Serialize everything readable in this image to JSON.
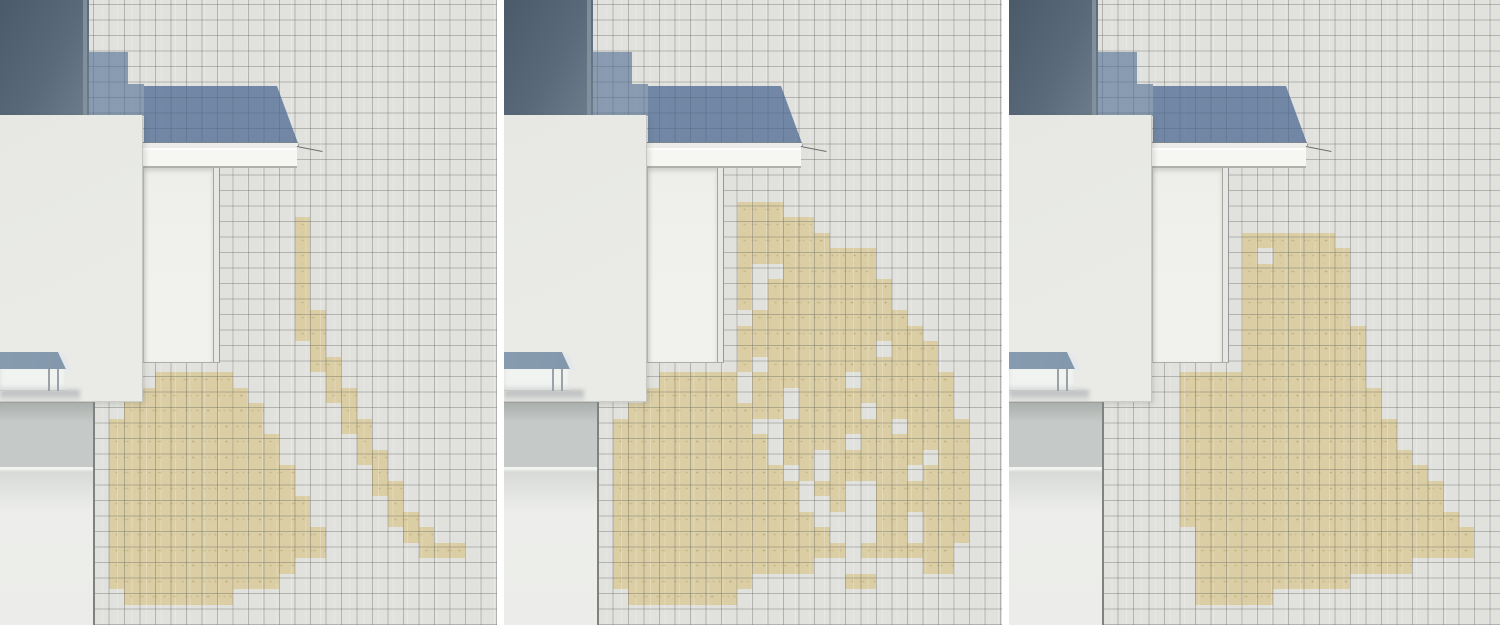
{
  "figure": {
    "panel_count": 3,
    "panel_ids": [
      "left",
      "middle",
      "right"
    ]
  },
  "colors": {
    "gutter": "#ffffff",
    "tile": "#e1e2de",
    "grid_line": "rgba(94,94,88,0.36)",
    "tan": "#dbcea4",
    "shadow_blue": "rgba(83,111,149,0.62)",
    "roof_blue": "rgba(70,100,143,0.72)",
    "chimney_dark": "#4b5a69",
    "chimney_mid": "#5a6979",
    "chimney_light": "#6d7d8c",
    "chimney_edge": "#8794a1",
    "eave": "#ecedea",
    "fascia": "#f6f6f3",
    "door": "#f1f1ee",
    "jamb": "#e7e7e3",
    "line_dark": "#a6a6a1",
    "panel_face": "#eaebe7",
    "panel_edge": "#c6c6c1",
    "awning_slope_dark": "#70849a",
    "awning_slope_light": "#8ca0b4",
    "awning_cap": "#e4e8eb",
    "awning_face": "#f1f3f1",
    "awning_post": "#9aa1a7",
    "band_top": "#aab0ad",
    "band": "#c5c9c7",
    "wall_shade": "#d8dad7",
    "wall_light": "#edeeeb",
    "corner": "#7f827f"
  },
  "layout": {
    "width": 1500,
    "height": 625,
    "tile_size": 15.5
  },
  "arch": {
    "chimney": {
      "x": 0,
      "y": 0,
      "w": 89,
      "h": 116
    },
    "chimney_edge": {
      "x": 83,
      "y": 0,
      "w": 4,
      "h": 116
    },
    "shadow_steps": [
      {
        "x": 88,
        "y": 52,
        "w": 40,
        "h": 64
      },
      {
        "x": 128,
        "y": 84,
        "w": 16,
        "h": 32
      }
    ],
    "roof": {
      "points": [
        [
          144,
          86
        ],
        [
          277,
          86
        ],
        [
          299,
          146
        ],
        [
          144,
          146
        ]
      ]
    },
    "eave_strip": {
      "x": 140,
      "y": 142,
      "w": 158,
      "h": 6
    },
    "fascia": {
      "x": 140,
      "y": 148,
      "w": 157,
      "h": 20
    },
    "leader": {
      "x": 297,
      "y": 146,
      "len": 26,
      "angle": 11
    },
    "door": {
      "x": 143,
      "y": 168,
      "w": 70,
      "h": 195
    },
    "jamb": {
      "x": 213,
      "y": 168,
      "w": 7,
      "h": 195
    },
    "front_panel": {
      "x": 0,
      "y": 115,
      "w": 143,
      "h": 287
    },
    "awning": {
      "slope": [
        [
          0,
          352
        ],
        [
          58,
          352
        ],
        [
          66,
          369
        ],
        [
          0,
          371
        ]
      ],
      "cap": [
        [
          58,
          352
        ],
        [
          66,
          355
        ],
        [
          72,
          371
        ],
        [
          66,
          369
        ]
      ],
      "face": {
        "x": 0,
        "y": 369,
        "w": 66,
        "h": 22
      },
      "posts": [
        {
          "x": 48,
          "y": 369,
          "w": 2,
          "h": 22
        },
        {
          "x": 57,
          "y": 369,
          "w": 2,
          "h": 22
        }
      ],
      "shadow": {
        "x": 0,
        "y": 390,
        "w": 80,
        "h": 13
      }
    },
    "base": {
      "band": {
        "x": 0,
        "y": 402,
        "w": 94,
        "h": 65
      },
      "wall": {
        "x": 0,
        "y": 467,
        "w": 94,
        "h": 158
      },
      "corner": {
        "x": 93,
        "y": 402,
        "w": 2,
        "h": 223
      }
    }
  },
  "panels": [
    {
      "id": "left",
      "x": 0,
      "w": 497,
      "rows": [
        {
          "r": 14,
          "segs": [
            [
              19,
              20
            ]
          ]
        },
        {
          "r": 15,
          "segs": [
            [
              19,
              20
            ]
          ]
        },
        {
          "r": 16,
          "segs": [
            [
              19,
              20
            ]
          ]
        },
        {
          "r": 17,
          "segs": [
            [
              19,
              20
            ]
          ]
        },
        {
          "r": 18,
          "segs": [
            [
              19,
              20
            ]
          ]
        },
        {
          "r": 19,
          "segs": [
            [
              19,
              20
            ]
          ]
        },
        {
          "r": 20,
          "segs": [
            [
              19,
              21
            ]
          ]
        },
        {
          "r": 21,
          "segs": [
            [
              19,
              21
            ]
          ]
        },
        {
          "r": 22,
          "segs": [
            [
              20,
              21
            ]
          ]
        },
        {
          "r": 23,
          "segs": [
            [
              20,
              22
            ]
          ]
        },
        {
          "r": 24,
          "segs": [
            [
              10,
              15
            ],
            [
              21,
              22
            ]
          ]
        },
        {
          "r": 25,
          "segs": [
            [
              8,
              16
            ],
            [
              21,
              23
            ]
          ]
        },
        {
          "r": 26,
          "segs": [
            [
              8,
              17
            ],
            [
              22,
              23
            ]
          ]
        },
        {
          "r": 27,
          "segs": [
            [
              7,
              17
            ],
            [
              22,
              24
            ]
          ]
        },
        {
          "r": 28,
          "segs": [
            [
              7,
              18
            ],
            [
              23,
              24
            ]
          ]
        },
        {
          "r": 29,
          "segs": [
            [
              7,
              18
            ],
            [
              23,
              25
            ]
          ]
        },
        {
          "r": 30,
          "segs": [
            [
              7,
              19
            ],
            [
              24,
              25
            ]
          ]
        },
        {
          "r": 31,
          "segs": [
            [
              7,
              19
            ],
            [
              24,
              26
            ]
          ]
        },
        {
          "r": 32,
          "segs": [
            [
              7,
              20
            ],
            [
              25,
              26
            ]
          ]
        },
        {
          "r": 33,
          "segs": [
            [
              7,
              20
            ],
            [
              25,
              27
            ]
          ]
        },
        {
          "r": 34,
          "segs": [
            [
              7,
              21
            ],
            [
              26,
              28
            ]
          ]
        },
        {
          "r": 35,
          "segs": [
            [
              7,
              21
            ],
            [
              27,
              30
            ]
          ]
        },
        {
          "r": 36,
          "segs": [
            [
              7,
              19
            ]
          ]
        },
        {
          "r": 37,
          "segs": [
            [
              7,
              18
            ]
          ]
        },
        {
          "r": 38,
          "segs": [
            [
              8,
              15
            ]
          ]
        }
      ]
    },
    {
      "id": "middle",
      "x": 504,
      "w": 498,
      "rows": [
        {
          "r": 13,
          "segs": [
            [
              15,
              18
            ]
          ]
        },
        {
          "r": 14,
          "segs": [
            [
              15,
              20
            ]
          ]
        },
        {
          "r": 15,
          "segs": [
            [
              15,
              21
            ]
          ]
        },
        {
          "r": 16,
          "segs": [
            [
              15,
              24
            ]
          ]
        },
        {
          "r": 17,
          "segs": [
            [
              15,
              16
            ],
            [
              18,
              24
            ]
          ]
        },
        {
          "r": 18,
          "segs": [
            [
              15,
              16
            ],
            [
              17,
              25
            ]
          ]
        },
        {
          "r": 19,
          "segs": [
            [
              15,
              16
            ],
            [
              17,
              25
            ]
          ]
        },
        {
          "r": 20,
          "segs": [
            [
              16,
              26
            ]
          ]
        },
        {
          "r": 21,
          "segs": [
            [
              15,
              27
            ]
          ]
        },
        {
          "r": 22,
          "segs": [
            [
              15,
              24
            ],
            [
              25,
              28
            ]
          ]
        },
        {
          "r": 23,
          "segs": [
            [
              15,
              16
            ],
            [
              17,
              28
            ]
          ]
        },
        {
          "r": 24,
          "segs": [
            [
              10,
              15
            ],
            [
              16,
              22
            ],
            [
              23,
              29
            ]
          ]
        },
        {
          "r": 25,
          "segs": [
            [
              9,
              15
            ],
            [
              16,
              18
            ],
            [
              19,
              29
            ]
          ]
        },
        {
          "r": 26,
          "segs": [
            [
              8,
              18
            ],
            [
              19,
              23
            ],
            [
              24,
              29
            ]
          ]
        },
        {
          "r": 27,
          "segs": [
            [
              7,
              16
            ],
            [
              18,
              25
            ],
            [
              26,
              30
            ]
          ]
        },
        {
          "r": 28,
          "segs": [
            [
              7,
              17
            ],
            [
              18,
              22
            ],
            [
              23,
              30
            ]
          ]
        },
        {
          "r": 29,
          "segs": [
            [
              7,
              17
            ],
            [
              18,
              20
            ],
            [
              21,
              27
            ],
            [
              28,
              30
            ]
          ]
        },
        {
          "r": 30,
          "segs": [
            [
              7,
              18
            ],
            [
              19,
              20
            ],
            [
              21,
              26
            ],
            [
              27,
              30
            ]
          ]
        },
        {
          "r": 31,
          "segs": [
            [
              7,
              19
            ],
            [
              20,
              22
            ],
            [
              24,
              30
            ]
          ]
        },
        {
          "r": 32,
          "segs": [
            [
              7,
              19
            ],
            [
              21,
              22
            ],
            [
              24,
              30
            ]
          ]
        },
        {
          "r": 33,
          "segs": [
            [
              7,
              20
            ],
            [
              24,
              26
            ],
            [
              27,
              30
            ]
          ]
        },
        {
          "r": 34,
          "segs": [
            [
              7,
              21
            ],
            [
              24,
              26
            ],
            [
              27,
              30
            ]
          ]
        },
        {
          "r": 35,
          "segs": [
            [
              7,
              22
            ],
            [
              23,
              29
            ]
          ]
        },
        {
          "r": 36,
          "segs": [
            [
              7,
              20
            ],
            [
              27,
              29
            ]
          ]
        },
        {
          "r": 37,
          "segs": [
            [
              7,
              16
            ],
            [
              22,
              24
            ]
          ]
        },
        {
          "r": 38,
          "segs": [
            [
              8,
              15
            ]
          ]
        }
      ]
    },
    {
      "id": "right",
      "x": 1009,
      "w": 491,
      "rows": [
        {
          "r": 15,
          "segs": [
            [
              15,
              21
            ]
          ]
        },
        {
          "r": 16,
          "segs": [
            [
              15,
              16
            ],
            [
              17,
              22
            ]
          ]
        },
        {
          "r": 17,
          "segs": [
            [
              15,
              22
            ]
          ]
        },
        {
          "r": 18,
          "segs": [
            [
              15,
              22
            ]
          ]
        },
        {
          "r": 19,
          "segs": [
            [
              15,
              22
            ]
          ]
        },
        {
          "r": 20,
          "segs": [
            [
              15,
              22
            ]
          ]
        },
        {
          "r": 21,
          "segs": [
            [
              15,
              23
            ]
          ]
        },
        {
          "r": 22,
          "segs": [
            [
              15,
              23
            ]
          ]
        },
        {
          "r": 23,
          "segs": [
            [
              15,
              23
            ]
          ]
        },
        {
          "r": 24,
          "segs": [
            [
              11,
              23
            ]
          ]
        },
        {
          "r": 25,
          "segs": [
            [
              11,
              24
            ]
          ]
        },
        {
          "r": 26,
          "segs": [
            [
              11,
              24
            ]
          ]
        },
        {
          "r": 27,
          "segs": [
            [
              11,
              25
            ]
          ]
        },
        {
          "r": 28,
          "segs": [
            [
              11,
              25
            ]
          ]
        },
        {
          "r": 29,
          "segs": [
            [
              11,
              26
            ]
          ]
        },
        {
          "r": 30,
          "segs": [
            [
              11,
              27
            ]
          ]
        },
        {
          "r": 31,
          "segs": [
            [
              11,
              28
            ]
          ]
        },
        {
          "r": 32,
          "segs": [
            [
              11,
              28
            ]
          ]
        },
        {
          "r": 33,
          "segs": [
            [
              11,
              29
            ]
          ]
        },
        {
          "r": 34,
          "segs": [
            [
              12,
              30
            ]
          ]
        },
        {
          "r": 35,
          "segs": [
            [
              12,
              30
            ]
          ]
        },
        {
          "r": 36,
          "segs": [
            [
              12,
              26
            ]
          ]
        },
        {
          "r": 37,
          "segs": [
            [
              12,
              22
            ]
          ]
        },
        {
          "r": 38,
          "segs": [
            [
              12,
              17
            ]
          ]
        }
      ]
    }
  ]
}
